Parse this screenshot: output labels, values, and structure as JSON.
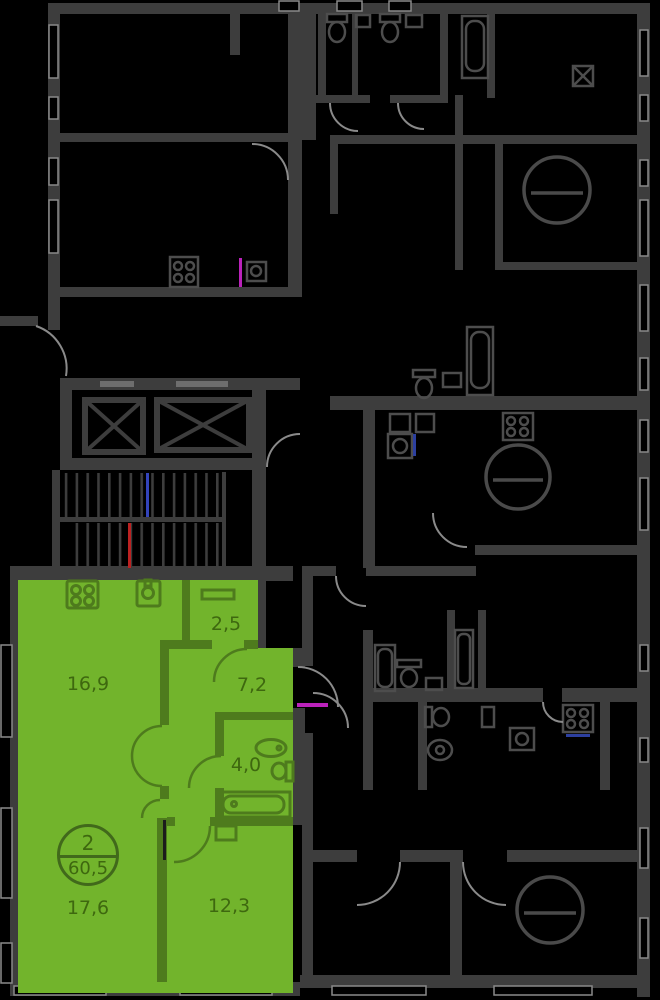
{
  "floorplan": {
    "type": "residential-floor-plan",
    "background_color": "#000000",
    "common_wall_color": "#3d3d3d",
    "highlighted_apartment": {
      "badge": {
        "rooms_count": "2",
        "total_area_m2": "60,5"
      },
      "rooms": [
        {
          "name": "kitchen-living-room",
          "area_m2": "16,9"
        },
        {
          "name": "wardrobe",
          "area_m2": "2,5"
        },
        {
          "name": "hallway",
          "area_m2": "7,2"
        },
        {
          "name": "bathroom",
          "area_m2": "4,0"
        },
        {
          "name": "bedroom",
          "area_m2": "17,6"
        },
        {
          "name": "room",
          "area_m2": "12,3"
        }
      ],
      "fill_color": "#72b42c",
      "wall_color": "#4e7b1d",
      "label_color": "#3e680f"
    },
    "markers": {
      "stair_line_blue": "#3344bb",
      "stair_line_red": "#bb2222",
      "entrance_line_magenta": "#bb22bb",
      "sink_line_blue": "#2c3f9f"
    }
  }
}
